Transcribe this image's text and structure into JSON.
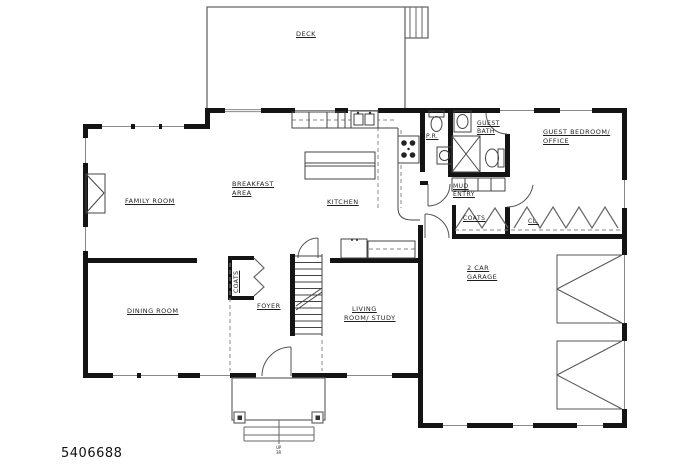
{
  "plan": {
    "number": "5406688",
    "rooms": {
      "deck": "DECK",
      "family_room": "FAMILY ROOM",
      "breakfast_line1": "BREAKFAST",
      "breakfast_line2": "AREA",
      "kitchen": "KITCHEN",
      "powder_room": "P.R.",
      "guest_bath_line1": "GUEST",
      "guest_bath_line2": "BATH",
      "guest_bedroom_line1": "GUEST BEDROOM/",
      "guest_bedroom_line2": "OFFICE",
      "mud_entry_line1": "MUD",
      "mud_entry_line2": "ENTRY",
      "hall_coats": "COATS",
      "hall_closet": "CL.",
      "foyer_coats": "COATS",
      "foyer": "FOYER",
      "dining_room": "DINING ROOM",
      "living_line1": "LIVING",
      "living_line2": "ROOM/ STUDY",
      "garage_line1": "2 CAR",
      "garage_line2": "GARAGE",
      "porch_steps_line1": "UP",
      "porch_steps_line2": "3R"
    },
    "colors": {
      "wall": "#141414",
      "line": "#555555",
      "text": "#1f1f1f"
    }
  }
}
